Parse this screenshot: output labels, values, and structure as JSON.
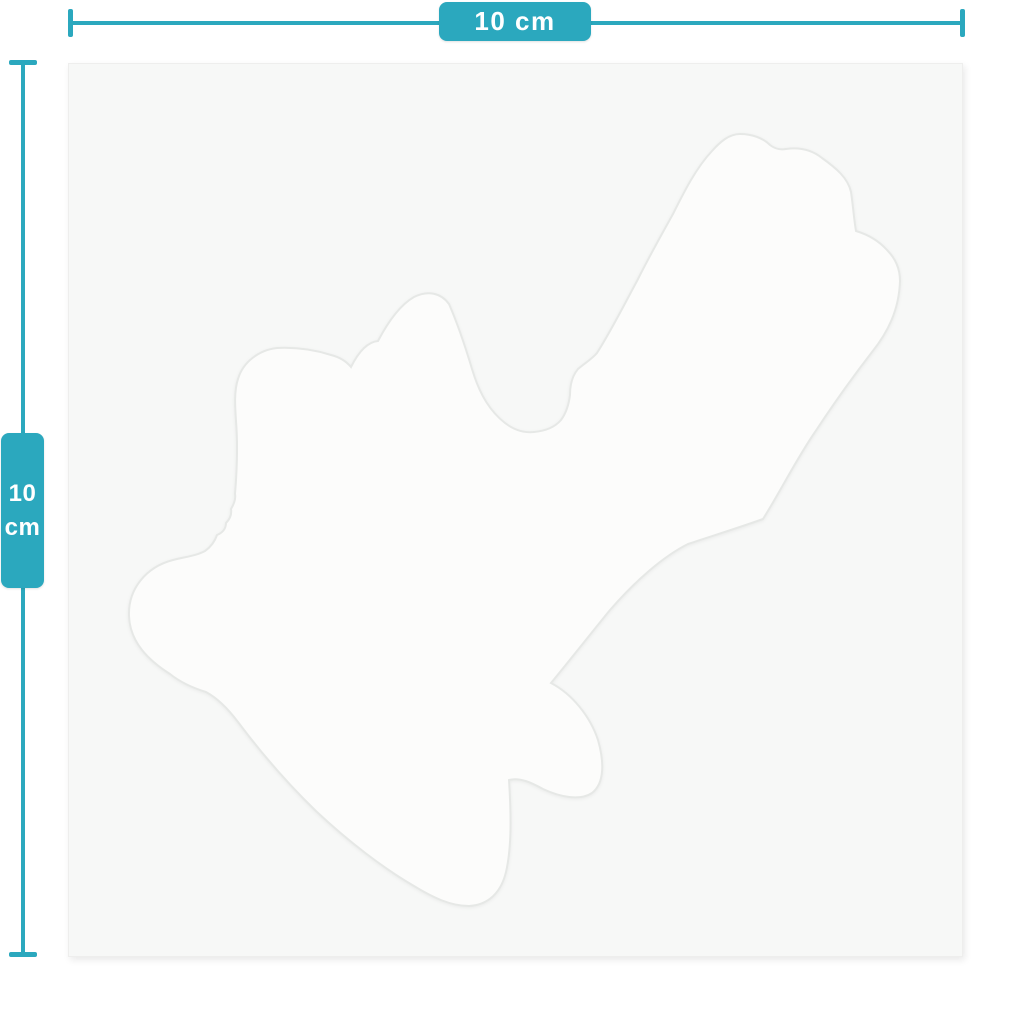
{
  "colors": {
    "accent": "#2ba8be",
    "sheet_bg": "#f7f8f7",
    "sticker_fill": "#fcfcfb",
    "sticker_edge": "#e6e8e6",
    "label_text": "#ffffff"
  },
  "width_dimension": {
    "label": "10 cm"
  },
  "height_dimension": {
    "value": "10",
    "unit": "cm"
  }
}
